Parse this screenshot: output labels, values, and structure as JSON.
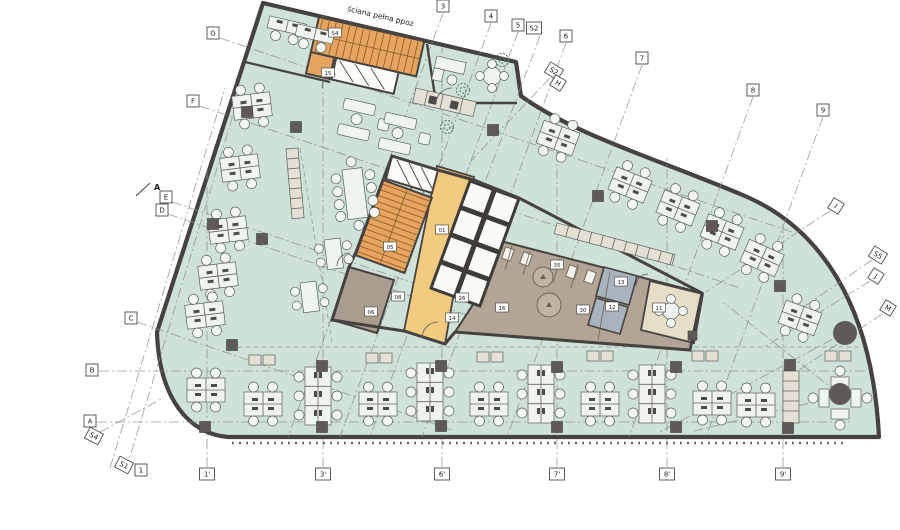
{
  "annotations": {
    "fire_wall_label": "ściana pełna ppoż",
    "section_label": "A"
  },
  "grid_markers": {
    "top": [
      {
        "label": "3",
        "x": 443,
        "y": 6,
        "rot": 0
      },
      {
        "label": "4",
        "x": 491,
        "y": 16,
        "rot": 0
      },
      {
        "label": "5",
        "x": 518,
        "y": 25,
        "rot": 0
      },
      {
        "label": "S2",
        "x": 534,
        "y": 28,
        "rot": 0
      },
      {
        "label": "6",
        "x": 566,
        "y": 36,
        "rot": 0
      },
      {
        "label": "7",
        "x": 642,
        "y": 58,
        "rot": 0
      },
      {
        "label": "8",
        "x": 753,
        "y": 90,
        "rot": 0
      },
      {
        "label": "9",
        "x": 823,
        "y": 110,
        "rot": 0
      }
    ],
    "right": [
      {
        "label": "S2",
        "x": 554,
        "y": 71,
        "rot": 32
      },
      {
        "label": "H",
        "x": 558,
        "y": 83,
        "rot": 32
      },
      {
        "label": "I",
        "x": 836,
        "y": 206,
        "rot": 32
      },
      {
        "label": "S5",
        "x": 878,
        "y": 255,
        "rot": 32
      },
      {
        "label": "J",
        "x": 876,
        "y": 276,
        "rot": 32
      },
      {
        "label": "M",
        "x": 888,
        "y": 308,
        "rot": 32
      }
    ],
    "left": [
      {
        "label": "G",
        "x": 213,
        "y": 33,
        "rot": 0
      },
      {
        "label": "F",
        "x": 193,
        "y": 101,
        "rot": 0
      },
      {
        "label": "E",
        "x": 166,
        "y": 197,
        "rot": 0
      },
      {
        "label": "D",
        "x": 162,
        "y": 210,
        "rot": 0
      },
      {
        "label": "C",
        "x": 131,
        "y": 318,
        "rot": 0
      },
      {
        "label": "B",
        "x": 92,
        "y": 370,
        "rot": 0
      },
      {
        "label": "A",
        "x": 90,
        "y": 421,
        "rot": 0
      },
      {
        "label": "S4",
        "x": 94,
        "y": 436,
        "rot": 28
      }
    ],
    "bottom": [
      {
        "label": "S1",
        "x": 124,
        "y": 465,
        "rot": 28
      },
      {
        "label": "1",
        "x": 141,
        "y": 470,
        "rot": 0
      },
      {
        "label": "1'",
        "x": 207,
        "y": 474,
        "rot": 0
      },
      {
        "label": "3'",
        "x": 323,
        "y": 474,
        "rot": 0
      },
      {
        "label": "6'",
        "x": 442,
        "y": 474,
        "rot": 0
      },
      {
        "label": "7'",
        "x": 557,
        "y": 474,
        "rot": 0
      },
      {
        "label": "8'",
        "x": 667,
        "y": 474,
        "rot": 0
      },
      {
        "label": "9'",
        "x": 783,
        "y": 474,
        "rot": 0
      }
    ]
  },
  "room_tags": [
    {
      "label": "S4",
      "x": 335,
      "y": 33
    },
    {
      "label": "15",
      "x": 328,
      "y": 73
    },
    {
      "label": "01",
      "x": 442,
      "y": 230
    },
    {
      "label": "05",
      "x": 390,
      "y": 247
    },
    {
      "label": "08",
      "x": 398,
      "y": 297
    },
    {
      "label": "06",
      "x": 371,
      "y": 312
    },
    {
      "label": "26",
      "x": 462,
      "y": 298
    },
    {
      "label": "14",
      "x": 452,
      "y": 318
    },
    {
      "label": "16",
      "x": 502,
      "y": 308
    },
    {
      "label": "35",
      "x": 557,
      "y": 265
    },
    {
      "label": "30",
      "x": 583,
      "y": 310
    },
    {
      "label": "13",
      "x": 621,
      "y": 282
    },
    {
      "label": "12",
      "x": 612,
      "y": 307
    },
    {
      "label": "11",
      "x": 659,
      "y": 308
    }
  ],
  "colors": {
    "green": "#cfe2d8",
    "orange": "#e5a45f",
    "yellow": "#f2ca80",
    "taupe": "#b3a595",
    "grayroom": "#a89d8e",
    "blue": "#a9b3bd",
    "beige": "#e6dfc8",
    "wall": "#454240",
    "column": "#5f5a55",
    "desk": "#eef4ee",
    "furniture_line": "#5a615c",
    "grid_line": "#8b8b8b"
  }
}
